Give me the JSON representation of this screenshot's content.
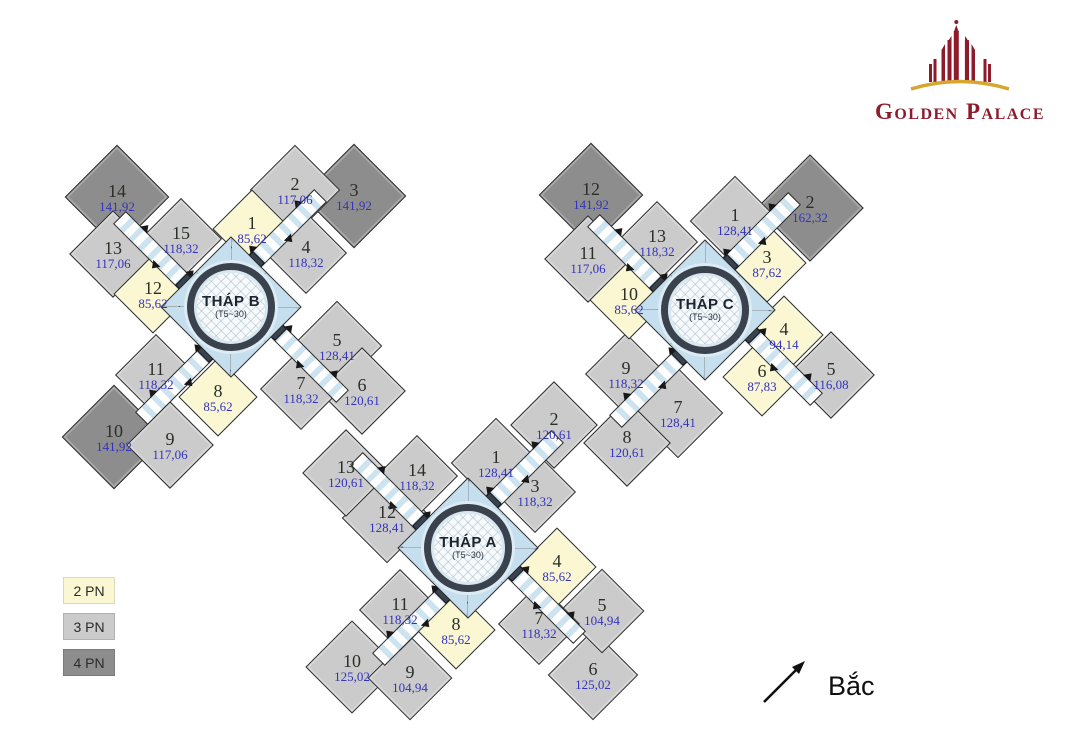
{
  "logo": {
    "text": "Golden Palace",
    "brand_color": "#8e1b2c",
    "gold_color": "#d6a62e",
    "icon": "golden-palace-building-icon"
  },
  "compass": {
    "label": "Bắc",
    "direction": "north-east-arrow"
  },
  "legend": {
    "items": [
      {
        "label": "2 PN",
        "type": "2pn",
        "color": "#faf7d2"
      },
      {
        "label": "3 PN",
        "type": "3pn",
        "color": "#cbcbcb"
      },
      {
        "label": "4 PN",
        "type": "4pn",
        "color": "#8d8d8d"
      }
    ]
  },
  "colors": {
    "outline": "#2e2e2e",
    "corridor_blue": "#cde3f0",
    "core_blue": "#c5dfee",
    "ring_dark": "#39424d",
    "unit_number": "#2b2f28",
    "unit_area": "#3333bb",
    "unit_types": {
      "2pn": "#faf7d2",
      "3pn": "#cbcbcb",
      "4pn": "#8d8d8d"
    }
  },
  "towers": [
    {
      "id": "B",
      "title": "THÁP B",
      "subtitle": "(T5~30)",
      "cx": 231,
      "cy": 307,
      "units": [
        {
          "n": "1",
          "area": "85,62",
          "t": "2pn",
          "x": 252,
          "y": 229,
          "s": 56
        },
        {
          "n": "2",
          "area": "117,06",
          "t": "3pn",
          "x": 295,
          "y": 190,
          "s": 64
        },
        {
          "n": "3",
          "area": "141,92",
          "t": "4pn",
          "x": 354,
          "y": 196,
          "s": 74
        },
        {
          "n": "4",
          "area": "118,32",
          "t": "3pn",
          "x": 306,
          "y": 253,
          "s": 58
        },
        {
          "n": "5",
          "area": "128,41",
          "t": "3pn",
          "x": 337,
          "y": 346,
          "s": 64
        },
        {
          "n": "6",
          "area": "120,61",
          "t": "3pn",
          "x": 362,
          "y": 391,
          "s": 62
        },
        {
          "n": "7",
          "area": "118,32",
          "t": "3pn",
          "x": 301,
          "y": 389,
          "s": 58
        },
        {
          "n": "8",
          "area": "85,62",
          "t": "2pn",
          "x": 218,
          "y": 397,
          "s": 56
        },
        {
          "n": "9",
          "area": "117,06",
          "t": "3pn",
          "x": 170,
          "y": 445,
          "s": 62
        },
        {
          "n": "10",
          "area": "141,92",
          "t": "4pn",
          "x": 114,
          "y": 437,
          "s": 74
        },
        {
          "n": "11",
          "area": "118,32",
          "t": "3pn",
          "x": 156,
          "y": 375,
          "s": 58
        },
        {
          "n": "12",
          "area": "85,62",
          "t": "2pn",
          "x": 153,
          "y": 294,
          "s": 56
        },
        {
          "n": "13",
          "area": "117,06",
          "t": "3pn",
          "x": 113,
          "y": 254,
          "s": 62
        },
        {
          "n": "14",
          "area": "141,92",
          "t": "4pn",
          "x": 117,
          "y": 197,
          "s": 74
        },
        {
          "n": "15",
          "area": "118,32",
          "t": "3pn",
          "x": 181,
          "y": 239,
          "s": 58
        }
      ]
    },
    {
      "id": "C",
      "title": "THÁP C",
      "subtitle": "(T5~30)",
      "cx": 705,
      "cy": 310,
      "units": [
        {
          "n": "1",
          "area": "128,41",
          "t": "3pn",
          "x": 735,
          "y": 221,
          "s": 64
        },
        {
          "n": "2",
          "area": "162,32",
          "t": "4pn",
          "x": 810,
          "y": 208,
          "s": 76
        },
        {
          "n": "3",
          "area": "87,62",
          "t": "2pn",
          "x": 767,
          "y": 263,
          "s": 56
        },
        {
          "n": "4",
          "area": "94,14",
          "t": "2pn",
          "x": 784,
          "y": 335,
          "s": 56
        },
        {
          "n": "5",
          "area": "116,08",
          "t": "3pn",
          "x": 831,
          "y": 375,
          "s": 62
        },
        {
          "n": "6",
          "area": "87,83",
          "t": "2pn",
          "x": 762,
          "y": 377,
          "s": 56
        },
        {
          "n": "7",
          "area": "128,41",
          "t": "3pn",
          "x": 678,
          "y": 413,
          "s": 64
        },
        {
          "n": "8",
          "area": "120,61",
          "t": "3pn",
          "x": 627,
          "y": 443,
          "s": 62
        },
        {
          "n": "9",
          "area": "118,32",
          "t": "3pn",
          "x": 626,
          "y": 374,
          "s": 58
        },
        {
          "n": "10",
          "area": "85,62",
          "t": "2pn",
          "x": 629,
          "y": 300,
          "s": 56
        },
        {
          "n": "11",
          "area": "117,06",
          "t": "3pn",
          "x": 588,
          "y": 259,
          "s": 62
        },
        {
          "n": "12",
          "area": "141,92",
          "t": "4pn",
          "x": 591,
          "y": 195,
          "s": 74
        },
        {
          "n": "13",
          "area": "118,32",
          "t": "3pn",
          "x": 657,
          "y": 242,
          "s": 58
        }
      ]
    },
    {
      "id": "A",
      "title": "THÁP A",
      "subtitle": "(T5~30)",
      "cx": 468,
      "cy": 548,
      "units": [
        {
          "n": "1",
          "area": "128,41",
          "t": "3pn",
          "x": 496,
          "y": 463,
          "s": 64
        },
        {
          "n": "2",
          "area": "120,61",
          "t": "3pn",
          "x": 554,
          "y": 425,
          "s": 62
        },
        {
          "n": "3",
          "area": "118,32",
          "t": "3pn",
          "x": 535,
          "y": 492,
          "s": 58
        },
        {
          "n": "4",
          "area": "85,62",
          "t": "2pn",
          "x": 557,
          "y": 567,
          "s": 56
        },
        {
          "n": "5",
          "area": "104,94",
          "t": "3pn",
          "x": 602,
          "y": 611,
          "s": 60
        },
        {
          "n": "6",
          "area": "125,02",
          "t": "3pn",
          "x": 593,
          "y": 675,
          "s": 64
        },
        {
          "n": "7",
          "area": "118,32",
          "t": "3pn",
          "x": 539,
          "y": 624,
          "s": 58
        },
        {
          "n": "8",
          "area": "85,62",
          "t": "2pn",
          "x": 456,
          "y": 630,
          "s": 56
        },
        {
          "n": "9",
          "area": "104,94",
          "t": "3pn",
          "x": 410,
          "y": 678,
          "s": 60
        },
        {
          "n": "10",
          "area": "125,02",
          "t": "3pn",
          "x": 352,
          "y": 667,
          "s": 66
        },
        {
          "n": "11",
          "area": "118,32",
          "t": "3pn",
          "x": 400,
          "y": 610,
          "s": 58
        },
        {
          "n": "12",
          "area": "128,41",
          "t": "3pn",
          "x": 387,
          "y": 518,
          "s": 64
        },
        {
          "n": "13",
          "area": "120,61",
          "t": "3pn",
          "x": 346,
          "y": 473,
          "s": 62
        },
        {
          "n": "14",
          "area": "118,32",
          "t": "3pn",
          "x": 417,
          "y": 476,
          "s": 58
        }
      ]
    }
  ]
}
